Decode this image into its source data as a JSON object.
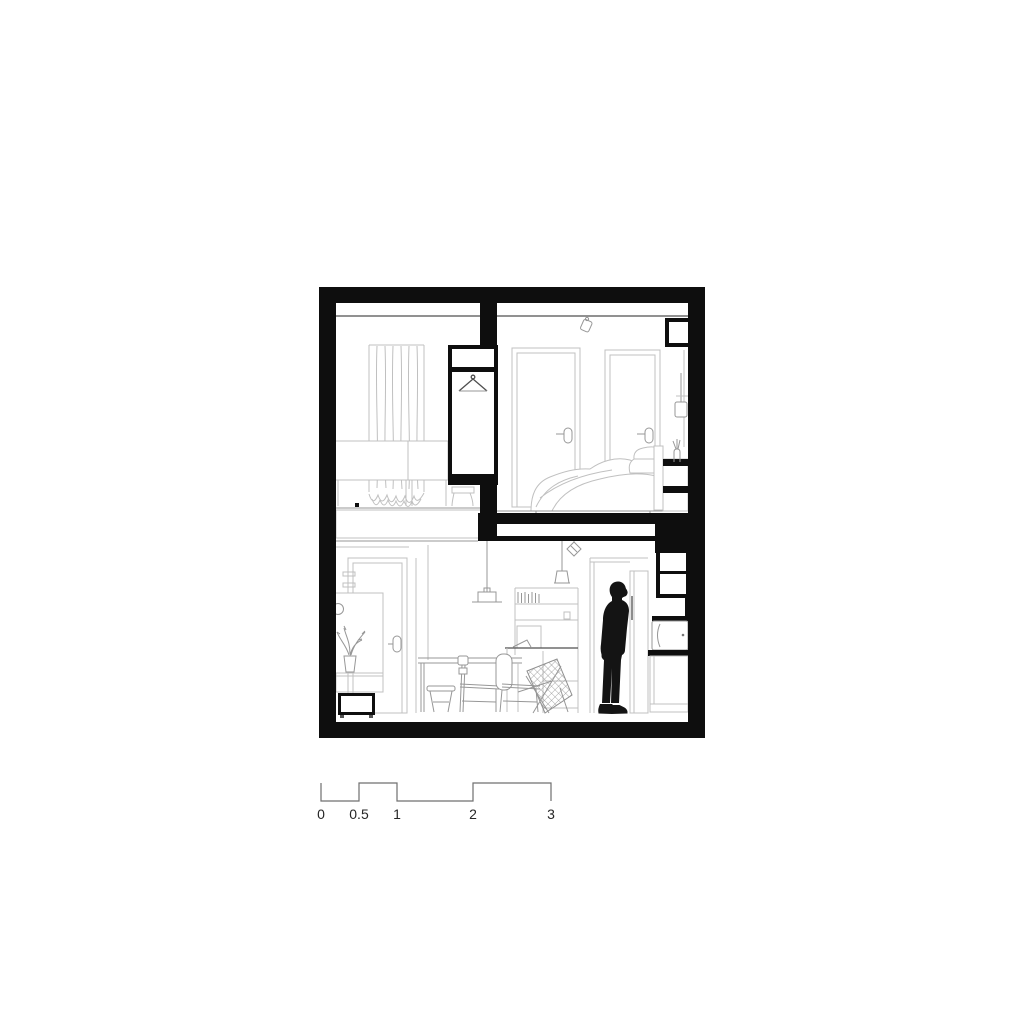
{
  "document": {
    "type": "architectural-section-drawing",
    "description": "Black and white cross-section of a two-level apartment: two upper bedrooms with wardrobe and doors, lower living space with desk, chairs, kitchen column and a standing human figure; metric scale bar below."
  },
  "scale_bar": {
    "unit_labels": [
      "0",
      "0.5",
      "1",
      "2",
      "3"
    ]
  },
  "colors": {
    "background": "#ffffff",
    "wall": "#0e0e0e",
    "figure": "#141414",
    "line-light": "#c0c0c0",
    "line-mid": "#979797",
    "line-dark": "#4f4f4f",
    "scale-line": "#6f6f6f",
    "scale-text": "#262626"
  }
}
